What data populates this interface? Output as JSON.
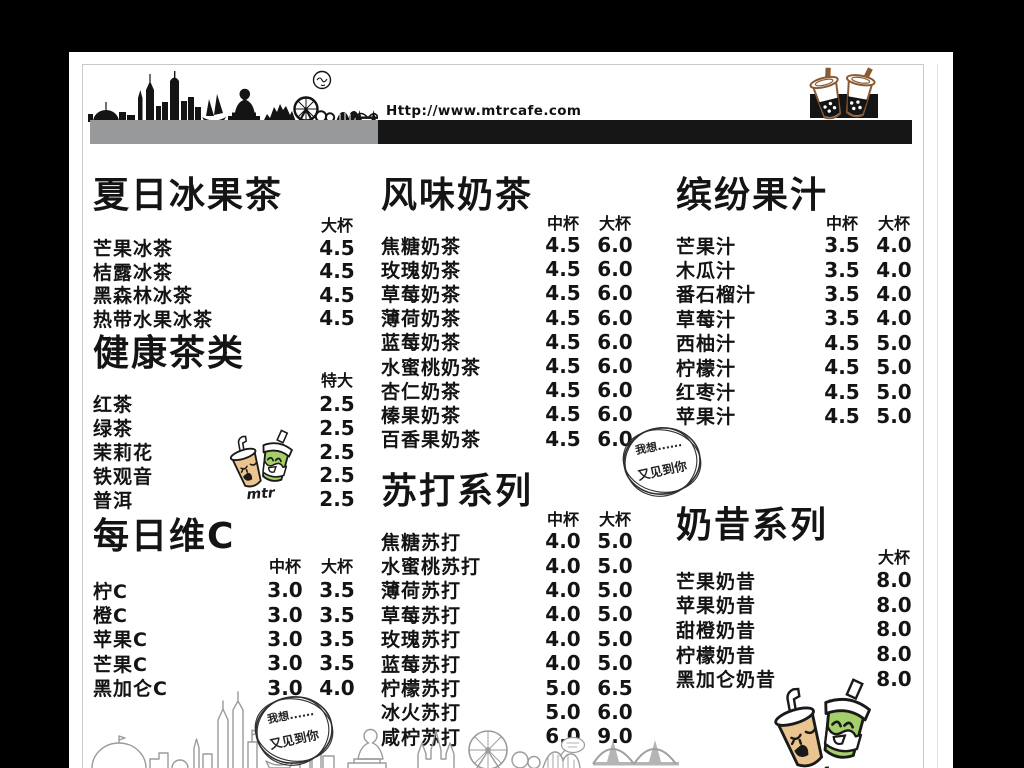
{
  "header": {
    "url": "Http://www.mtrcafe.com"
  },
  "badge": {
    "line1": "我想......",
    "line2": "又见到你"
  },
  "mascots": {
    "small_label": "mtr",
    "large_label": "mtc"
  },
  "colors": {
    "bar_gray": "#97999b",
    "bar_black": "#161616",
    "cup_brown": "#8a5a33",
    "mascot_tan": "#eac58f",
    "mascot_green": "#a5cf6b",
    "outline_gray": "#9b9b9b"
  },
  "menu": {
    "sections": [
      {
        "title": "夏日冰果茶",
        "headers": [
          "大杯"
        ],
        "items": [
          {
            "name": "芒果冰茶",
            "p1": "4.5"
          },
          {
            "name": "桔露冰茶",
            "p1": "4.5"
          },
          {
            "name": "黑森林冰茶",
            "p1": "4.5"
          },
          {
            "name": "热带水果冰茶",
            "p1": "4.5"
          }
        ]
      },
      {
        "title": "健康茶类",
        "headers": [
          "特大"
        ],
        "items": [
          {
            "name": "红茶",
            "p1": "2.5"
          },
          {
            "name": "绿茶",
            "p1": "2.5"
          },
          {
            "name": "茉莉花",
            "p1": "2.5"
          },
          {
            "name": "铁观音",
            "p1": "2.5"
          },
          {
            "name": "普洱",
            "p1": "2.5"
          }
        ]
      },
      {
        "title": "每日维C",
        "headers": [
          "中杯",
          "大杯"
        ],
        "items": [
          {
            "name": "柠C",
            "p1": "3.0",
            "p2": "3.5"
          },
          {
            "name": "橙C",
            "p1": "3.0",
            "p2": "3.5"
          },
          {
            "name": "苹果C",
            "p1": "3.0",
            "p2": "3.5"
          },
          {
            "name": "芒果C",
            "p1": "3.0",
            "p2": "3.5"
          },
          {
            "name": "黑加仑C",
            "p1": "3.0",
            "p2": "4.0"
          }
        ]
      },
      {
        "title": "风味奶茶",
        "headers": [
          "中杯",
          "大杯"
        ],
        "items": [
          {
            "name": "焦糖奶茶",
            "p1": "4.5",
            "p2": "6.0"
          },
          {
            "name": "玫瑰奶茶",
            "p1": "4.5",
            "p2": "6.0"
          },
          {
            "name": "草莓奶茶",
            "p1": "4.5",
            "p2": "6.0"
          },
          {
            "name": "薄荷奶茶",
            "p1": "4.5",
            "p2": "6.0"
          },
          {
            "name": "蓝莓奶茶",
            "p1": "4.5",
            "p2": "6.0"
          },
          {
            "name": "水蜜桃奶茶",
            "p1": "4.5",
            "p2": "6.0"
          },
          {
            "name": "杏仁奶茶",
            "p1": "4.5",
            "p2": "6.0"
          },
          {
            "name": "榛果奶茶",
            "p1": "4.5",
            "p2": "6.0"
          },
          {
            "name": "百香果奶茶",
            "p1": "4.5",
            "p2": "6.0"
          }
        ]
      },
      {
        "title": "苏打系列",
        "headers": [
          "中杯",
          "大杯"
        ],
        "items": [
          {
            "name": "焦糖苏打",
            "p1": "4.0",
            "p2": "5.0"
          },
          {
            "name": "水蜜桃苏打",
            "p1": "4.0",
            "p2": "5.0"
          },
          {
            "name": "薄荷苏打",
            "p1": "4.0",
            "p2": "5.0"
          },
          {
            "name": "草莓苏打",
            "p1": "4.0",
            "p2": "5.0"
          },
          {
            "name": "玫瑰苏打",
            "p1": "4.0",
            "p2": "5.0"
          },
          {
            "name": "蓝莓苏打",
            "p1": "4.0",
            "p2": "5.0"
          },
          {
            "name": "柠檬苏打",
            "p1": "5.0",
            "p2": "6.5"
          },
          {
            "name": "冰火苏打",
            "p1": "5.0",
            "p2": "6.0"
          },
          {
            "name": "咸柠苏打",
            "p1": "6.0",
            "p2": "9.0"
          }
        ]
      },
      {
        "title": "缤纷果汁",
        "headers": [
          "中杯",
          "大杯"
        ],
        "items": [
          {
            "name": "芒果汁",
            "p1": "3.5",
            "p2": "4.0"
          },
          {
            "name": "木瓜汁",
            "p1": "3.5",
            "p2": "4.0"
          },
          {
            "name": "番石榴汁",
            "p1": "3.5",
            "p2": "4.0"
          },
          {
            "name": "草莓汁",
            "p1": "3.5",
            "p2": "4.0"
          },
          {
            "name": "西柚汁",
            "p1": "4.5",
            "p2": "5.0"
          },
          {
            "name": "柠檬汁",
            "p1": "4.5",
            "p2": "5.0"
          },
          {
            "name": "红枣汁",
            "p1": "4.5",
            "p2": "5.0"
          },
          {
            "name": "苹果汁",
            "p1": "4.5",
            "p2": "5.0"
          }
        ]
      },
      {
        "title": "奶昔系列",
        "headers": [
          "大杯"
        ],
        "items": [
          {
            "name": "芒果奶昔",
            "p1": "8.0"
          },
          {
            "name": "苹果奶昔",
            "p1": "8.0"
          },
          {
            "name": "甜橙奶昔",
            "p1": "8.0"
          },
          {
            "name": "柠檬奶昔",
            "p1": "8.0"
          },
          {
            "name": "黑加仑奶昔",
            "p1": "8.0"
          }
        ]
      }
    ]
  }
}
